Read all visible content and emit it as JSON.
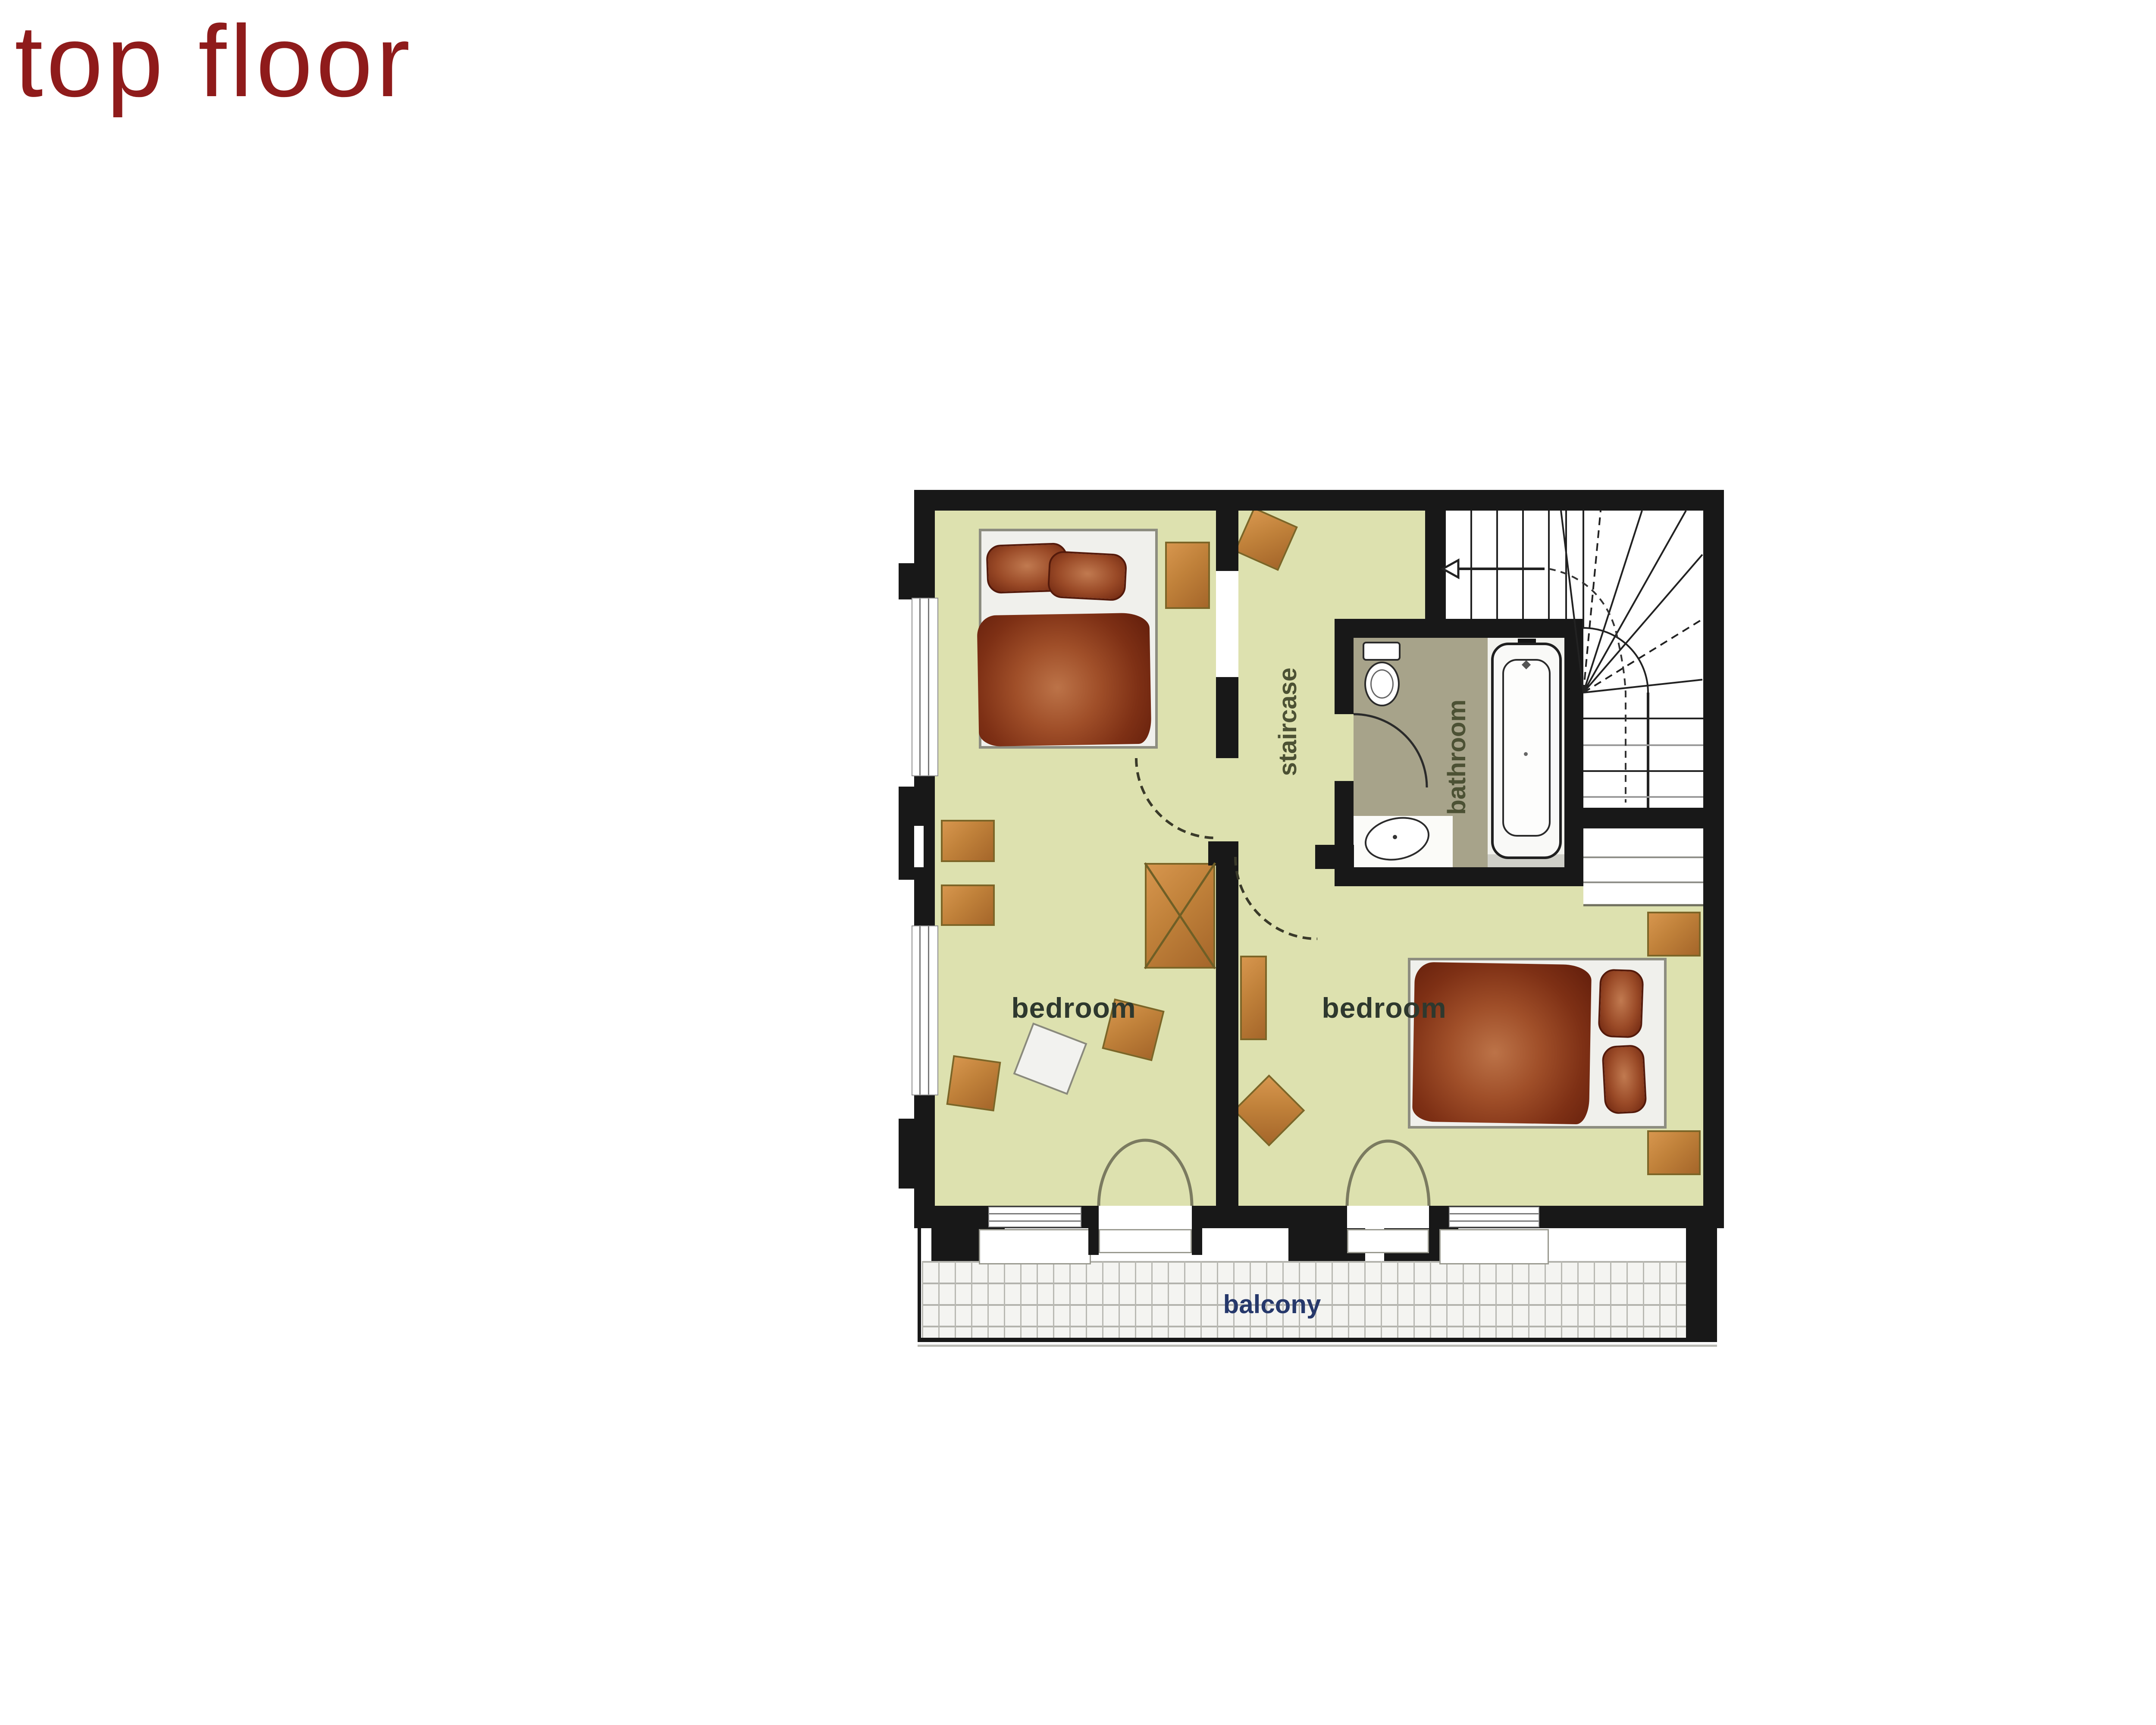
{
  "page": {
    "title": "top floor"
  },
  "plan": {
    "labels": {
      "bedroom_left": "bedroom",
      "bedroom_right": "bedroom",
      "staircase": "staircase",
      "bathroom": "bathroom",
      "balcony": "balcony"
    },
    "colors": {
      "title_red": "#8f1b1b",
      "wall_black": "#181818",
      "floor_yellow": "#dde1af",
      "bathroom_olive": "#a7a38a",
      "furniture_brown": "#c0813a",
      "bedding_maroon": "#7e3015",
      "room_label_dark": "#2e382e",
      "stair_label_olive": "#4c5134",
      "balcony_label_navy": "#26386b"
    }
  }
}
